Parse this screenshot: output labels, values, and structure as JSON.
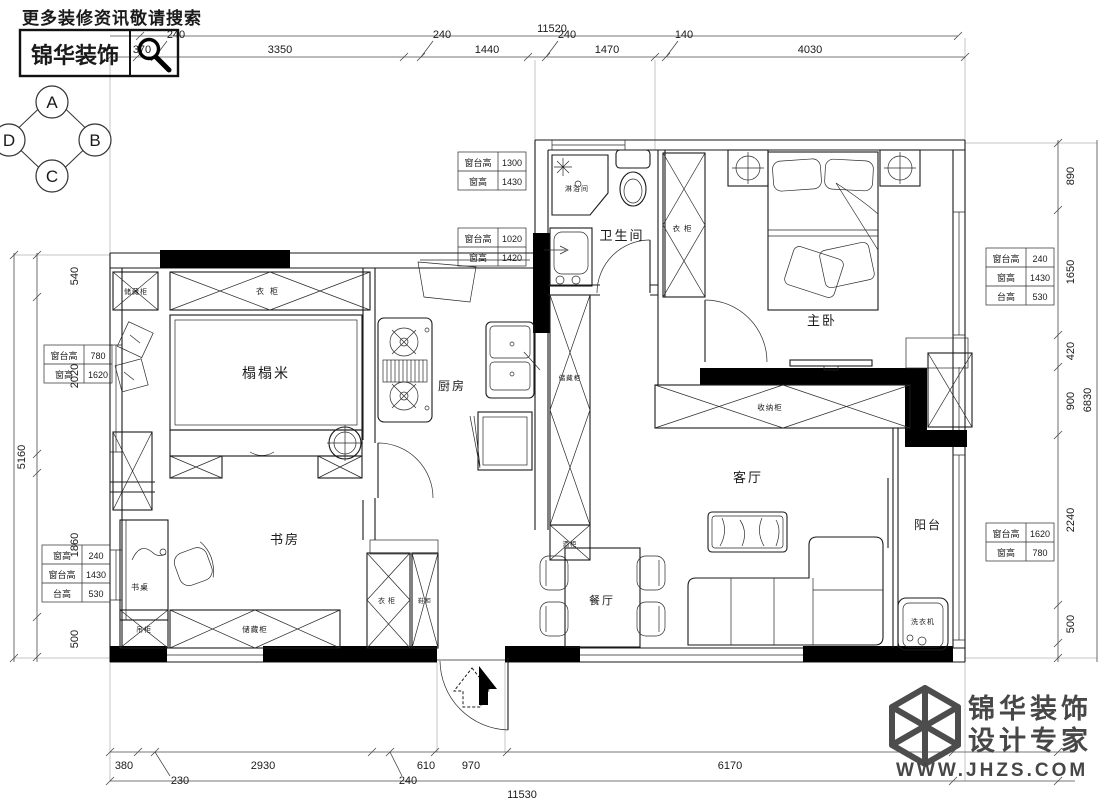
{
  "header": {
    "search_hint": "更多装修资讯敬请搜索",
    "brand": "锦华装饰"
  },
  "compass": {
    "top": "A",
    "right": "B",
    "bottom": "C",
    "left": "D"
  },
  "rooms": {
    "tatami": "榻榻米",
    "kitchen": "厨房",
    "bathroom": "卫生间",
    "shower": "淋浴间",
    "master_bedroom": "主卧",
    "living_room": "客厅",
    "study": "书房",
    "dining": "餐厅",
    "balcony": "阳台"
  },
  "furniture": {
    "wardrobe_tatami": "衣柜",
    "storage_tatami": "储藏柜",
    "storage_hall": "储藏柜",
    "wine_cabinet": "酒柜",
    "wardrobe_bath": "衣柜",
    "storage_living": "收纳柜",
    "desk": "书桌",
    "hanging_cabinet": "吊柜",
    "storage_study": "储藏柜",
    "wardrobe_study": "衣柜",
    "shoe_cabinet": "鞋柜",
    "washing_machine": "洗衣机"
  },
  "dims": {
    "top": {
      "total": "11520",
      "segs": [
        "370",
        "240",
        "3350",
        "240",
        "1440",
        "240",
        "1470",
        "140",
        "4030"
      ]
    },
    "bottom": {
      "total": "11530",
      "segs": [
        "380",
        "230",
        "2930",
        "240",
        "610",
        "970",
        "6170"
      ]
    },
    "left": {
      "total": "5160",
      "segs": [
        "540",
        "2020",
        "1860",
        "500"
      ]
    },
    "right": {
      "total": "6830",
      "segs": [
        "890",
        "1650",
        "420",
        "900",
        "2240",
        "500"
      ]
    }
  },
  "win_tables": {
    "bath_top": [
      [
        "窗台高",
        "1300"
      ],
      [
        "窗高",
        "1430"
      ]
    ],
    "kitchen_top": [
      [
        "窗台高",
        "1020"
      ],
      [
        "窗高",
        "1420"
      ]
    ],
    "tatami_left": [
      [
        "窗台高",
        "780"
      ],
      [
        "窗高",
        "1620"
      ]
    ],
    "study_left": [
      [
        "窗高",
        "240"
      ],
      [
        "窗台高",
        "1430"
      ],
      [
        "台高",
        "530"
      ]
    ],
    "bedroom_right": [
      [
        "窗台高",
        "240"
      ],
      [
        "窗高",
        "1430"
      ],
      [
        "台高",
        "530"
      ]
    ],
    "balcony_right": [
      [
        "窗台高",
        "1620"
      ],
      [
        "窗高",
        "780"
      ]
    ]
  },
  "footer": {
    "brand_line1": "锦华装饰",
    "brand_line2": "设计专家",
    "url": "WWW.JHZS.COM"
  }
}
